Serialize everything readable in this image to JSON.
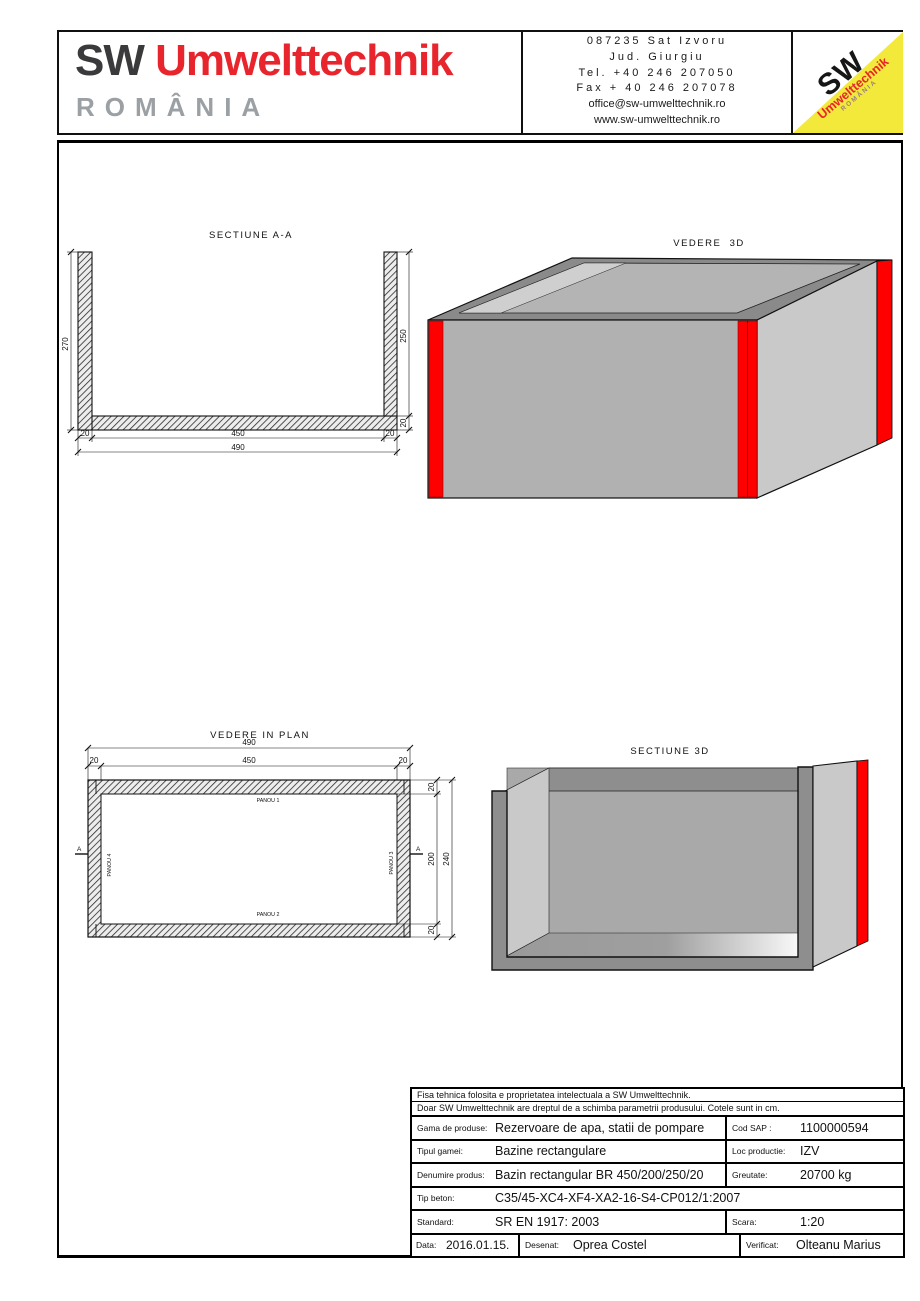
{
  "colors": {
    "brand_red": "#e8252c",
    "logo_gray": "#9ba0a5",
    "badge_yellow": "#f2e93b",
    "panel_red": "#ff0000",
    "concrete_gray": "#b1b1b1"
  },
  "header": {
    "logo": {
      "sw": "SW",
      "name": "Umwelttechnik",
      "country": "ROMÂNIA"
    },
    "contact_lines": [
      "087235 Sat Izvoru",
      "Jud. Giurgiu",
      "Tel. +40 246 207050",
      "Fax + 40 246 207078",
      "office@sw-umwelttechnik.ro",
      "www.sw-umwelttechnik.ro"
    ],
    "badge": {
      "sw": "SW",
      "name": "Umwelttechnik",
      "country": "ROMÂNIA"
    }
  },
  "drawings": {
    "section_aa": {
      "title": "SECTIUNE A-A",
      "dim_left_height": "270",
      "dim_right_height": "250",
      "dim_slab": "20",
      "dim_bottom_left_wall": "20",
      "dim_bottom_inner": "450",
      "dim_bottom_right_wall": "20",
      "dim_bottom_total": "490"
    },
    "view_3d": {
      "title": "VEDERE  3D"
    },
    "plan": {
      "title": "VEDERE IN PLAN",
      "dim_top_total": "490",
      "dim_top_inner": "450",
      "dim_top_left_wall": "20",
      "dim_top_right_wall": "20",
      "dim_right_top_wall": "20",
      "dim_right_inner": "200",
      "dim_right_bottom_wall": "20",
      "dim_right_total": "240",
      "panou1": "PANOU 1",
      "panou2": "PANOU 2",
      "panou3": "PANOU 3",
      "panou4": "PANOU 4",
      "marker_a": "A"
    },
    "section_3d": {
      "title": "SECTIUNE 3D"
    }
  },
  "table": {
    "note_line1": "Fisa tehnica folosita e proprietatea intelectuala a SW Umwelttechnik.",
    "note_line2": "Doar SW Umwelttechnik are dreptul de a schimba parametrii produsului. Cotele sunt in cm.",
    "gama": {
      "label": "Gama de produse:",
      "value": "Rezervoare de apa, statii de pompare"
    },
    "cod_sap": {
      "label": "Cod SAP :",
      "value": "1100000594"
    },
    "tipul": {
      "label": "Tipul gamei:",
      "value": "Bazine rectangulare"
    },
    "loc": {
      "label": "Loc productie:",
      "value": "IZV"
    },
    "denumire": {
      "label": "Denumire produs:",
      "value": "Bazin rectangular BR 450/200/250/20"
    },
    "greutate": {
      "label": "Greutate:",
      "value": "20700 kg"
    },
    "tip_beton": {
      "label": "Tip beton:",
      "value": "C35/45-XC4-XF4-XA2-16-S4-CP012/1:2007"
    },
    "standard": {
      "label": "Standard:",
      "value": "SR EN 1917: 2003"
    },
    "scara": {
      "label": "Scara:",
      "value": "1:20"
    },
    "data": {
      "label": "Data:",
      "value": "2016.01.15."
    },
    "desenat": {
      "label": "Desenat:",
      "value": "Oprea Costel"
    },
    "verificat": {
      "label": "Verificat:",
      "value": "Olteanu Marius"
    }
  }
}
